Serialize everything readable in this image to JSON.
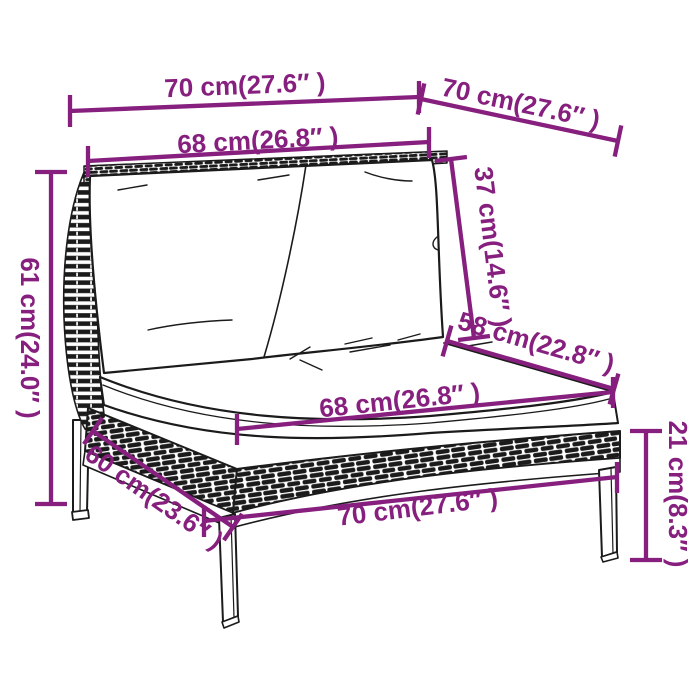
{
  "canvas": {
    "width": 700,
    "height": 700,
    "background": "#ffffff"
  },
  "style": {
    "dimension_color": "#861F7E",
    "ink_color": "#1b1b1b"
  },
  "dimensions": {
    "top_width": {
      "label": "70 cm(27.6″ )",
      "cm": "70",
      "inch": "27.6"
    },
    "top_depth": {
      "label": "70 cm(27.6″ )",
      "cm": "70",
      "inch": "27.6"
    },
    "back_width": {
      "label": "68 cm(26.8″ )",
      "cm": "68",
      "inch": "26.8"
    },
    "back_height": {
      "label": "37 cm(14.6″ )",
      "cm": "37",
      "inch": "14.6"
    },
    "overall_height": {
      "label": "61 cm(24.0″ )",
      "cm": "61",
      "inch": "24.0"
    },
    "seat_depth": {
      "label": "58 cm(22.8″ )",
      "cm": "58",
      "inch": "22.8"
    },
    "seat_width": {
      "label": "68 cm(26.8″ )",
      "cm": "68",
      "inch": "26.8"
    },
    "base_side_depth": {
      "label": "60 cm(23.6″ )",
      "cm": "60",
      "inch": "23.6"
    },
    "base_width": {
      "label": "70 cm(27.6″ )",
      "cm": "70",
      "inch": "27.6"
    },
    "leg_height": {
      "label": "21 cm(8.3″ )",
      "cm": "21",
      "inch": "8.3"
    }
  }
}
